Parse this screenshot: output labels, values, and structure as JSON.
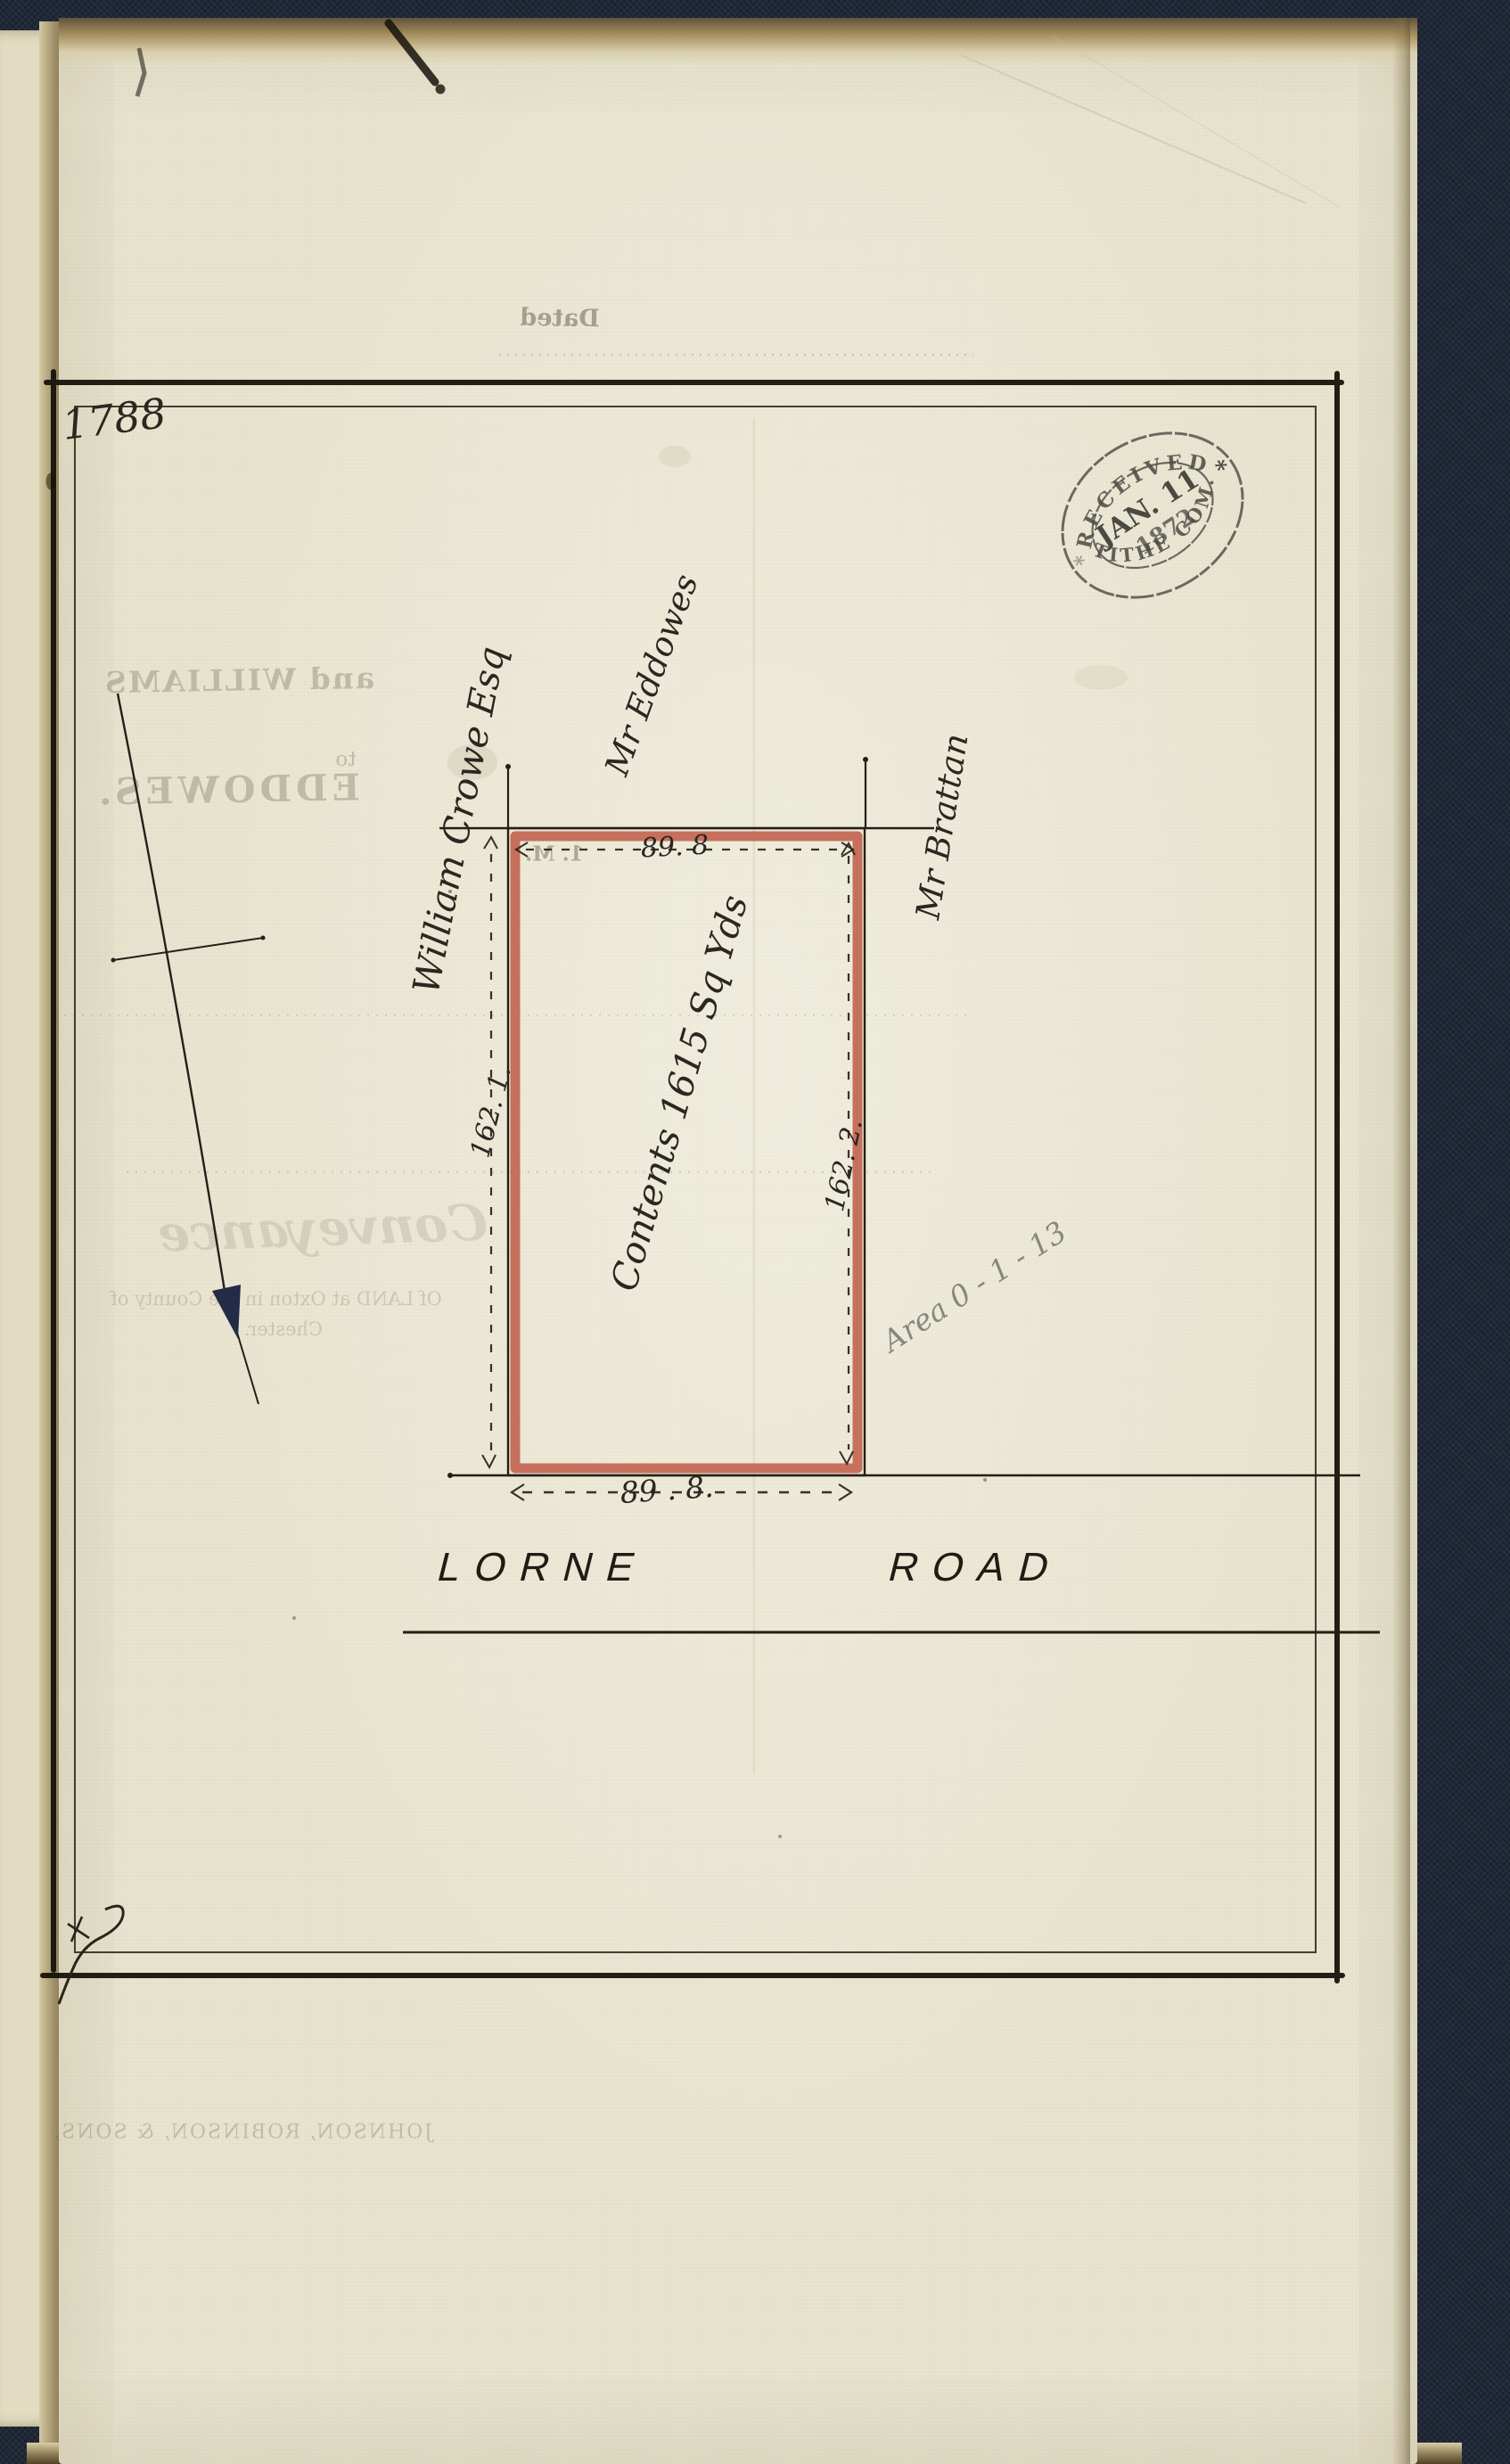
{
  "plot_number": "1788",
  "stamp": {
    "top": "RECEIVED",
    "date": "JAN. 11",
    "year": "1872",
    "bottom": "TITHE COM.",
    "asterisk": "*"
  },
  "plan": {
    "owner": "William Crowe Esq",
    "neighbor_top": "Mr Eddowes",
    "neighbor_right": "Mr Brattan",
    "contents": "Contents 1615 Sq Yds",
    "width_top": "89. 8",
    "width_bottom": "89 . 8.",
    "height_left": "162. 1.",
    "height_right": "162. 2.",
    "pencil_note": "Area 0 - 1 - 13"
  },
  "road": {
    "word1": "LORNE",
    "word2": "ROAD"
  },
  "ghost": {
    "dated": "Dated",
    "parties_line1": "and WILLIAMS",
    "to": "to",
    "parties_line2": "EDDOWES.",
    "fragment": "1. M.",
    "doc_type": "Conveyance",
    "subject_line1": "Of LAND at Oxton in the County of",
    "subject_line2": "Chester.",
    "imprint": "JOHNSON, ROBINSON, & SONS,"
  },
  "colors": {
    "plot_outline_red": "#c05a46",
    "ink": "#2b2620",
    "paper": "#e8e4cf",
    "cover": "#202838",
    "stamp_ink": "#2f2e29",
    "pencil": "#7e7d72",
    "north_arrow_head": "#232b47"
  }
}
